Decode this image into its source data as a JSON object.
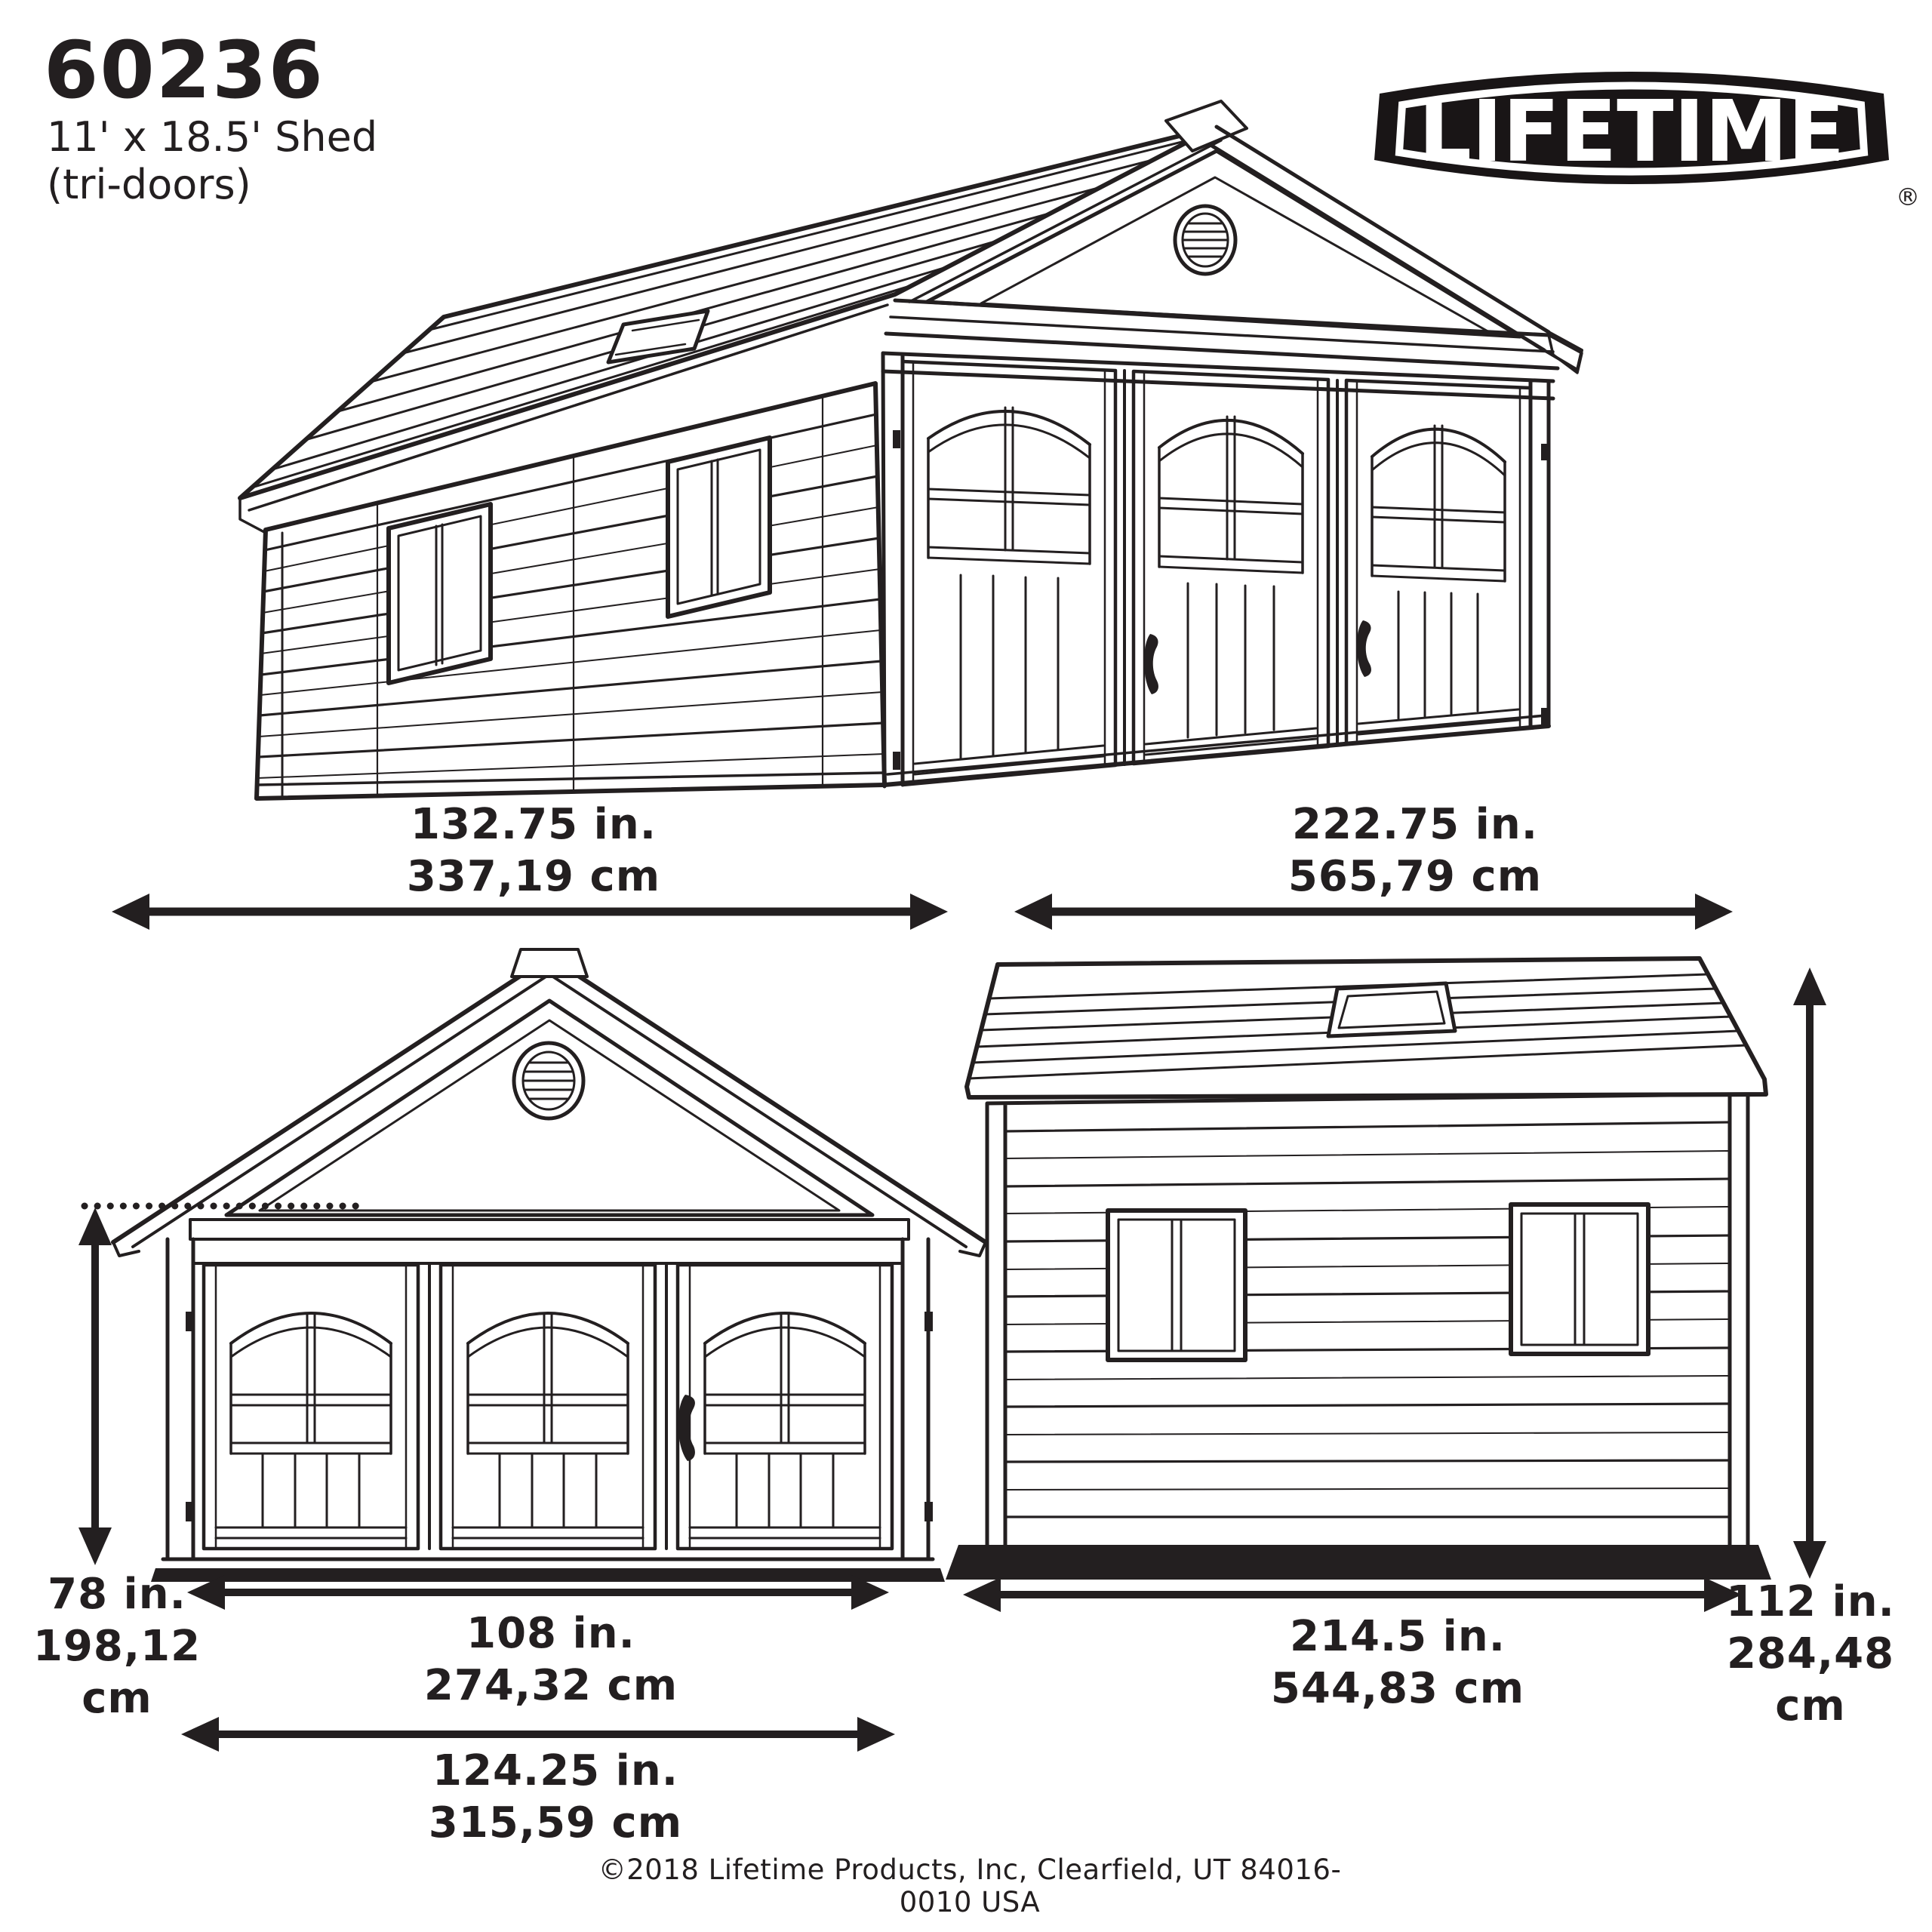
{
  "header": {
    "model_number": "60236",
    "size_label": "11' x 18.5' Shed",
    "variant_label": "(tri-doors)"
  },
  "brand": {
    "logo_text": "LIFETIME",
    "registered_mark": "®"
  },
  "dimensions": {
    "side_width": {
      "inches": "132.75 in.",
      "cm": "337,19 cm"
    },
    "front_width": {
      "inches": "222.75 in.",
      "cm": "565,79 cm"
    },
    "wall_height": {
      "inches": "78 in.",
      "cm": "198,12 cm"
    },
    "door_opening_width": {
      "inches": "108 in.",
      "cm": "274,32 cm"
    },
    "front_base_width": {
      "inches": "124.25 in.",
      "cm": "315,59 cm"
    },
    "side_base_width": {
      "inches": "214.5 in.",
      "cm": "544,83 cm"
    },
    "peak_height": {
      "inches": "112 in.",
      "cm": "284,48 cm"
    }
  },
  "footer": {
    "copyright": "©2018 Lifetime Products, Inc, Clearfield, UT 84016-0010 USA"
  },
  "colors": {
    "line_art": "#231f20",
    "text": "#231f20",
    "logo_fill": "#191516",
    "background": "#ffffff"
  }
}
